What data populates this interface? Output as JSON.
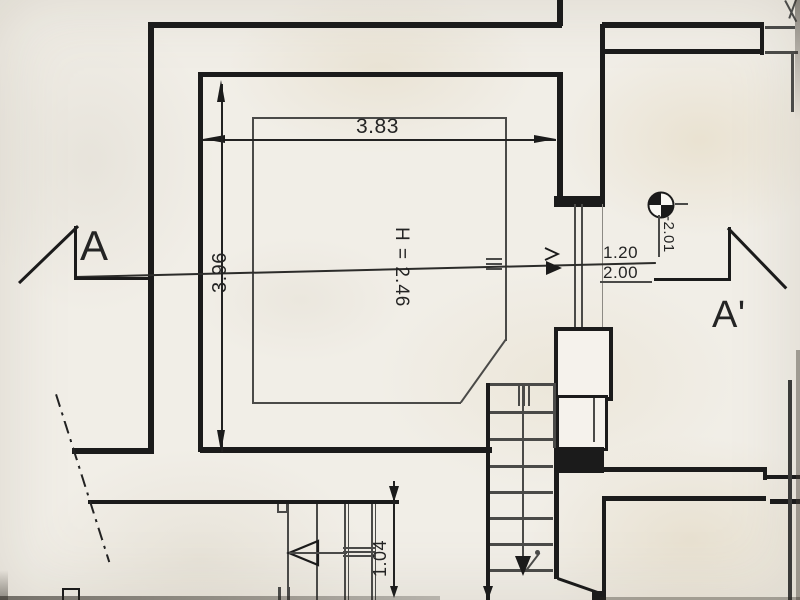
{
  "drawing": {
    "section_labels": {
      "a": "A",
      "a_prime": "A'"
    },
    "dims": {
      "room_width": "3.83",
      "room_depth": "3.96",
      "room_height": "H = 2.46",
      "opening_upper": "1.20",
      "opening_lower": "2.00",
      "stair_opening": "1.04",
      "level": "-2.01"
    },
    "colors": {
      "paper": "#f1eee7",
      "ink": "#1b1b1b"
    },
    "icons": {
      "level_marker": "quartered-circle-benchmark-icon"
    }
  }
}
